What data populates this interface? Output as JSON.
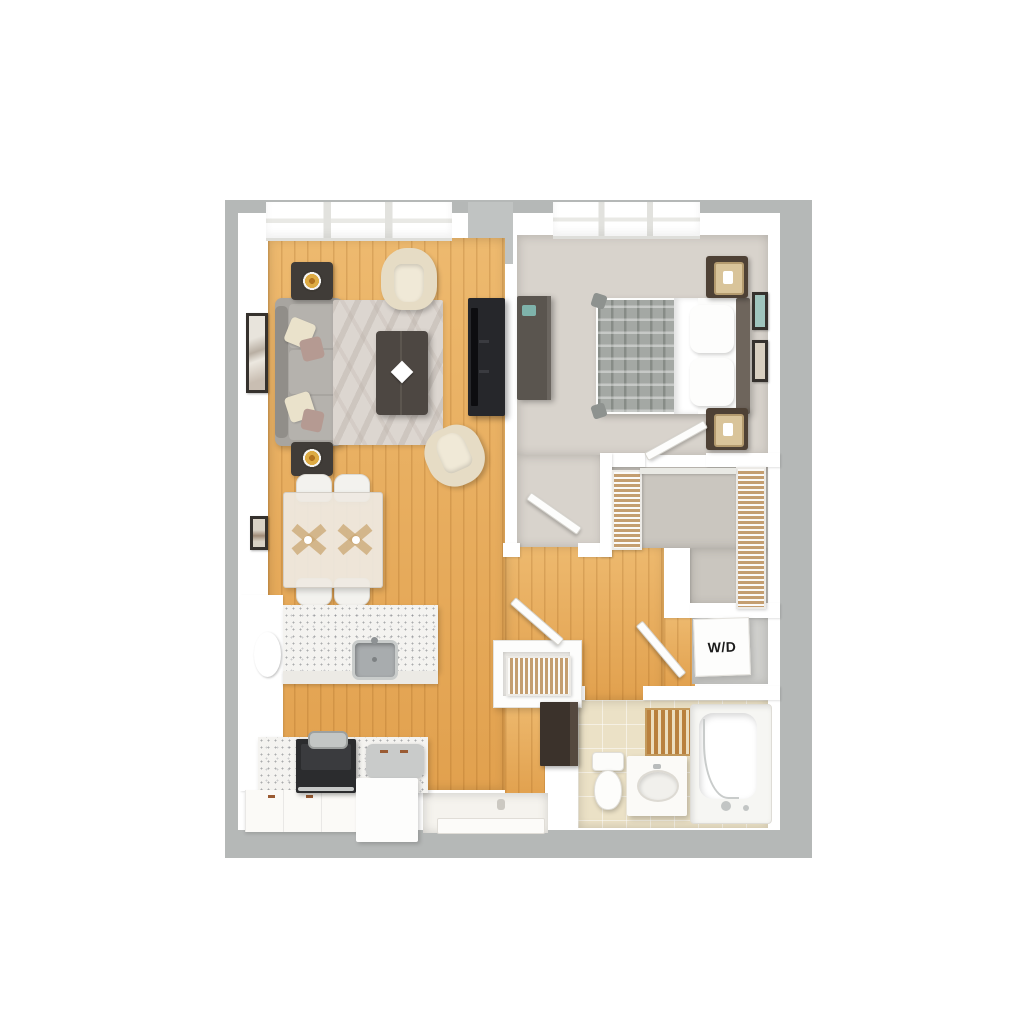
{
  "floor_plan": {
    "labels": {
      "washer_dryer": "W/D"
    },
    "palette": {
      "background": "#ffffff",
      "outer_wall_gray": "#b5b8b7",
      "inner_wall_white": "#ffffff",
      "wood_floor": "#e6a755",
      "bedroom_carpet": "#d8d3cc",
      "closet_carpet": "#cac6bf",
      "bathroom_tile": "#ebe1c6",
      "counter_speckle": "#f4f3f0",
      "dark_furniture": "#26272b",
      "bed_blanket": "#a4a8a4",
      "shelf_tan": "#c49e70"
    }
  }
}
